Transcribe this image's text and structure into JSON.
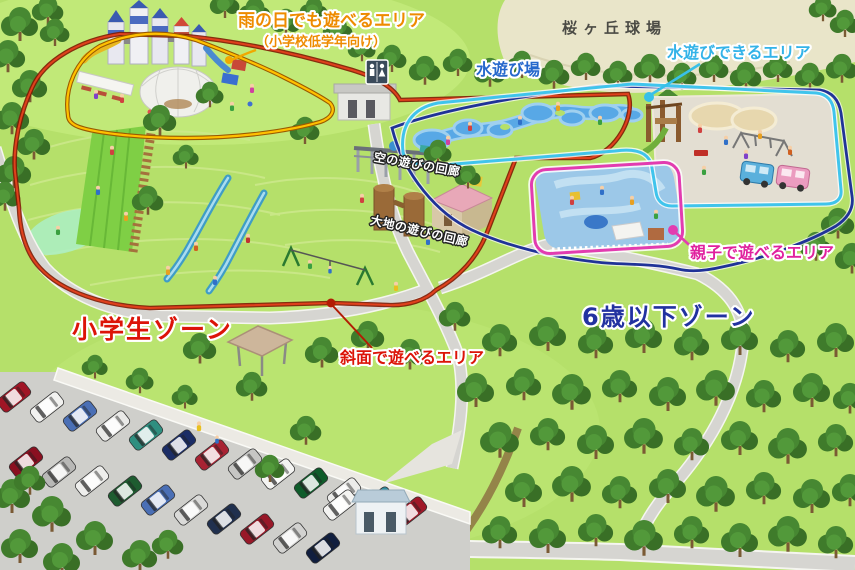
{
  "zones": [
    {
      "label": "小学生ゾーン",
      "color": "#dc1408",
      "boundary_color": "#b21c04"
    },
    {
      "label": "6歳以下ゾーン",
      "color": "#2232a0",
      "boundary_color": "#203398"
    }
  ],
  "areas": [
    {
      "label": "雨の日でも遊べるエリア",
      "note": "（小学校低学年向け）",
      "color": "#ee8b00",
      "boundary_color": "#ffc000"
    },
    {
      "label": "水遊び場",
      "color": "#2668cc"
    },
    {
      "label": "水遊びできるエリア",
      "color": "#33b3e8",
      "boundary_color": "#40c4ec"
    },
    {
      "label": "空の遊びの回廊",
      "color": "#ffffff"
    },
    {
      "label": "大地の遊びの回廊",
      "color": "#ffffff"
    },
    {
      "label": "親子で遊べるエリア",
      "color": "#e0219e",
      "boundary_color": "#e23cb0"
    },
    {
      "label": "斜面で遊べるエリア",
      "color": "#dc1408"
    }
  ],
  "landmarks": [
    {
      "label": "桜ヶ丘球場",
      "color": "#4b4b45"
    }
  ],
  "icons": {
    "restroom_sign": "male-female-restroom"
  },
  "palette": {
    "grass": "#b5e06a",
    "forest": "#3d7a2a",
    "ballpark_field": "#e9e5c9",
    "road": "#d6d5d1",
    "parking": "#cfcfcb",
    "pond": "#58a8e6"
  }
}
